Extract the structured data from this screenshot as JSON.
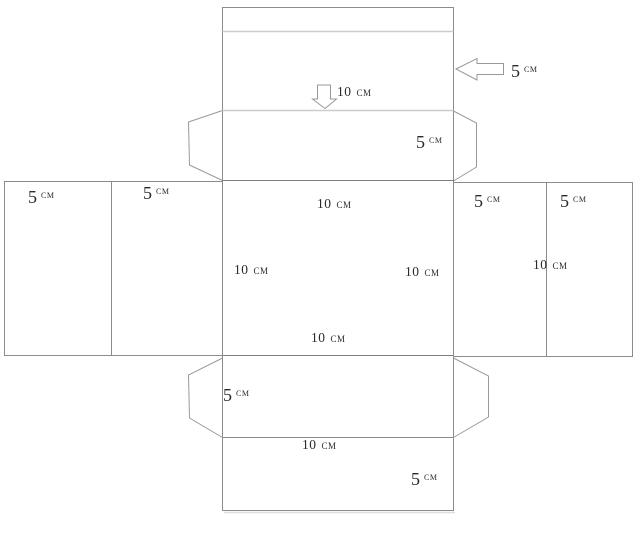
{
  "colors": {
    "background": "#ffffff",
    "outline": "#8c8c8c",
    "fold_line": "#cccccc",
    "arrow_stroke": "#999999",
    "text": "#2a2a2a"
  },
  "labels": {
    "lid_height": {
      "value": "5",
      "unit": "см"
    },
    "lid_width": {
      "value": "10",
      "unit": "см"
    },
    "top_flap_height": {
      "value": "5",
      "unit": "см"
    },
    "left_outer_panel": {
      "value": "5",
      "unit": "см"
    },
    "left_inner_panel": {
      "value": "5",
      "unit": "см"
    },
    "front_top_edge": {
      "value": "10",
      "unit": "см"
    },
    "right_inner_panel": {
      "value": "5",
      "unit": "см"
    },
    "right_outer_panel": {
      "value": "5",
      "unit": "см"
    },
    "front_left_edge": {
      "value": "10",
      "unit": "см"
    },
    "front_right_edge": {
      "value": "10",
      "unit": "см"
    },
    "right_panel_divider": {
      "value": "10",
      "unit": "см"
    },
    "front_bottom_edge": {
      "value": "10",
      "unit": "см"
    },
    "bottom_flap_height": {
      "value": "5",
      "unit": "см"
    },
    "bottom_lid_width": {
      "value": "10",
      "unit": "см"
    },
    "bottom_lid_height": {
      "value": "5",
      "unit": "см"
    }
  }
}
